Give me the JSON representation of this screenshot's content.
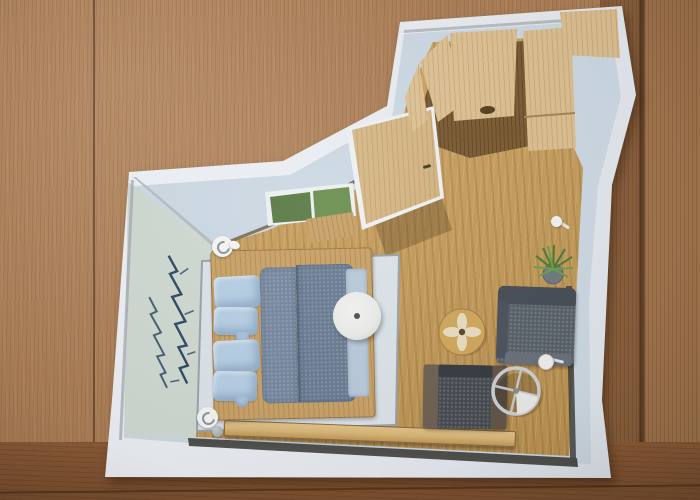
{
  "meta": {
    "description": "Photograph of a hand-cut printed bird's-eye 3D floor plan of a bedroom lying on a wooden table",
    "image_width": 700,
    "image_height": 500,
    "visible_text": ""
  },
  "scene": {
    "background": "wooden table surface with vertical grain planks",
    "paper": "irregularly cut glossy paper with a top-down interior rendering of a bedroom",
    "labels": {
      "table": "wooden table surface",
      "paper": "cut-out printed floor plan",
      "room": "bedroom top-down rendering",
      "mural": "mountain sketch wall mural",
      "window": "window with green garden view",
      "door": "wooden entry door",
      "wardrobe": "built-in wardrobe with wooden panels",
      "floor": "light oak room floor",
      "rug": "large light-grey area rug",
      "bed": "double bed with split grey duvet",
      "pillows": "two pairs of light blue pillows",
      "runner": "light blue bed runner at foot of bed",
      "pendant": "round white pendant lamp over bed edge",
      "sconce": "white wall sconce",
      "bench": "long wooden wall bench",
      "stool": "round wooden stool with flower decoration",
      "armchair": "dark armchair with wooden side tables",
      "sofa": "dark grey two-seat sofa",
      "side_table": "round metal-frame side table",
      "floor_lamp": "small white floor lamp",
      "plant": "green potted plant",
      "hook": "white wall hook"
    }
  },
  "colors": {
    "wood_base": "#ac7f57",
    "wood_right": "#8a603d",
    "wood_right2": "#a1754d",
    "wood_bottom": "#8c5c38",
    "paper": "#e8ecf1",
    "wall": "#cdd9e3",
    "wall_left": "#cfd9d1",
    "wall_dark": "#43433f",
    "mural": "#2e4b63",
    "floor": "#c69e5e",
    "closet_floor": "#7b5c33",
    "wood_panel": "#dcc091",
    "door_wood": "#d2b27f",
    "window_green": "#5f8049",
    "window_green2": "#7fa35e",
    "sill": "#c8a269",
    "rug": "#dce3e8",
    "rug_edge": "#9aa3ab",
    "bed_frame": "#c9a267",
    "pillow": "#b6cee4",
    "duvet": "#75879f",
    "duvet2": "#697b93",
    "runner": "#b9cadb",
    "disc": "#ebebe9",
    "sconce": "#f4f5f4",
    "bench": "#d8b678",
    "sofa": "#586069",
    "sofa_back": "#474e57",
    "chair_seat": "#464b51",
    "chair_arm": "#6f6253",
    "chair_arm2": "#635648",
    "stool": "#d0a85c",
    "stool_flower": "#ece1ca",
    "metal": "#cdd0d2",
    "lamp": "#efefed",
    "plant": "#527c3a",
    "plant2": "#6da04b",
    "pot": "#717a80"
  }
}
